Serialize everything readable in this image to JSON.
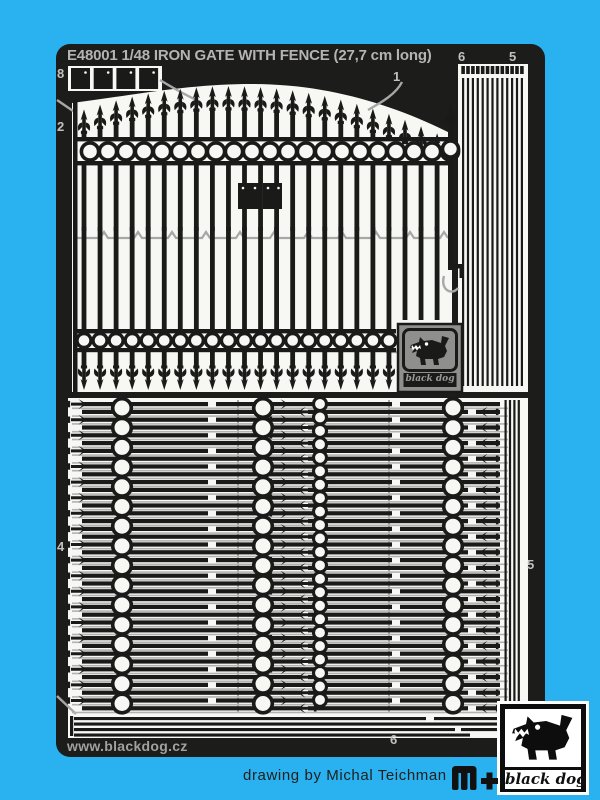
{
  "sheet": {
    "title": "E48001 1/48 IRON GATE WITH FENCE (27,7 cm long)",
    "website": "www.blackdog.cz",
    "labels": {
      "hinges": "8",
      "gate_left": "2",
      "gate_top": "1",
      "strips_inner_top": "6",
      "strips_outer_top": "5",
      "fence_left": "4",
      "fence_right": "5",
      "rails_bottom": "6"
    }
  },
  "branding": {
    "etched_logo_text": "black dog",
    "corner_logo_text": "black dog",
    "credit": "drawing by Michal Teichman"
  },
  "colors": {
    "background": "#29b2ef",
    "plate": "#1c1c1a",
    "metal": "#f7f7f4",
    "part_black": "#1a1a18",
    "connector_gray": "#a7a7a5",
    "label_gray": "#c2c1bf",
    "logo_gray": "#8f8f8d"
  },
  "icons": {
    "etched_logo": "blackdog-dog-icon",
    "corner_logo": "blackdog-dog-icon",
    "mplus": "mplus-logo-icon"
  }
}
